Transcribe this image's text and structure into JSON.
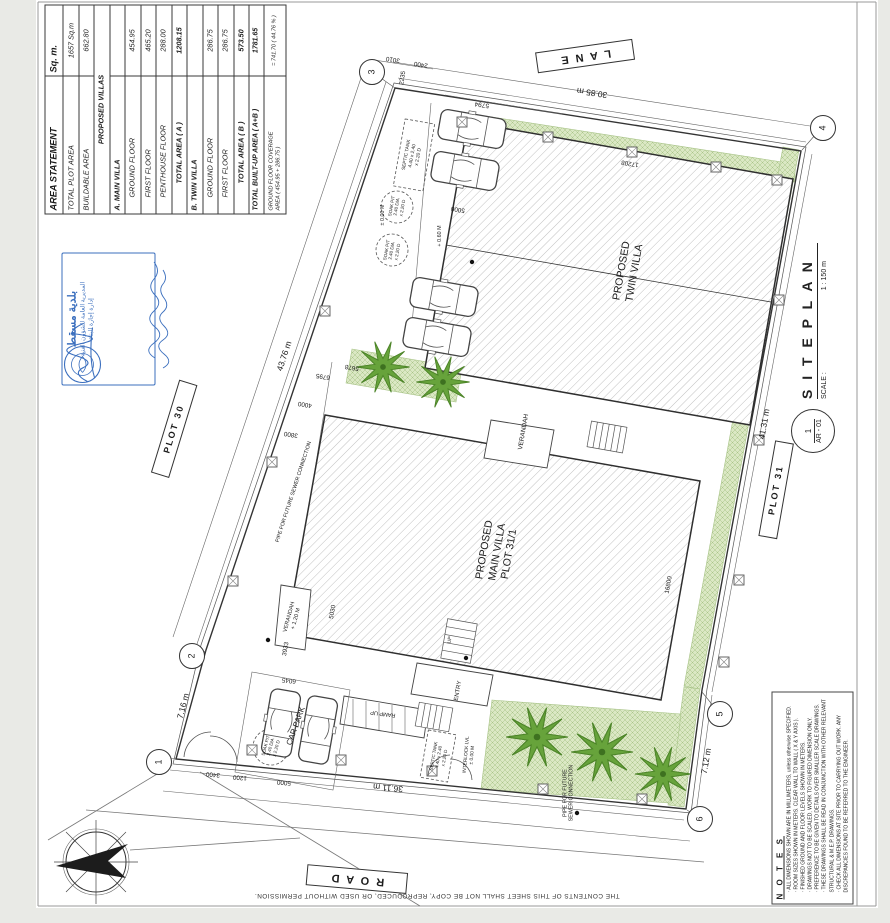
{
  "area_statement": {
    "title": "AREA STATEMENT",
    "unit": "Sq. m.",
    "rows": [
      {
        "label": "TOTAL PLOT AREA",
        "value": "1657 Sq.m",
        "cls": "plotrow"
      },
      {
        "label": "BUILDABLE AREA",
        "value": "662.80",
        "cls": ""
      },
      {
        "label": "PROPOSED VILLAS",
        "value": "",
        "cls": "section"
      },
      {
        "label": "A.   MAIN VILLA",
        "value": "",
        "cls": "villa"
      },
      {
        "label": "GROUND FLOOR",
        "value": "454.95",
        "cls": "indent"
      },
      {
        "label": "FIRST FLOOR",
        "value": "465.20",
        "cls": "indent"
      },
      {
        "label": "PENTHOUSE FLOOR",
        "value": "288.00",
        "cls": "indent"
      },
      {
        "label": "TOTAL AREA ( A )",
        "value": "1208.15",
        "cls": "total"
      },
      {
        "label": "B.   TWIN VILLA",
        "value": "",
        "cls": "villa"
      },
      {
        "label": "GROUND FLOOR",
        "value": "286.75",
        "cls": "indent"
      },
      {
        "label": "FIRST FLOOR",
        "value": "286.75",
        "cls": "indent"
      },
      {
        "label": "TOTAL AREA ( B )",
        "value": "573.50",
        "cls": "total"
      },
      {
        "label": "TOTAL BUILT-UP AREA  ( A+B )",
        "value": "1781.65",
        "cls": "grand"
      },
      {
        "label": "GROUND FLOOR COVERAGE\nAREA ( 454.95 + 286.75 )",
        "value": "=  741.70  ( 44.76 % )",
        "cls": "coverage"
      }
    ]
  },
  "stamp": {
    "title": "بلدية مسقط",
    "line2": "المديرية العامة للشؤون الفنية",
    "line3": "إدارة إجازة البناء"
  },
  "title_block": {
    "number": "1",
    "code": "AR - 01",
    "title": "S I T E   P L A N",
    "scale_label": "SCALE :",
    "scale": "1 : 150 m"
  },
  "notes": {
    "title": "N O T E S",
    "items": [
      "ALL DIMENSIONS SHOWN ARE IN MILLIMETERS, unless otherwise SPECIFIED.",
      "ROOM SIZES SHOWN IN METERS. CLEAR WALL TO WALL ( X & Y AXIS ).",
      "FINISHED GROUND AND FLOOR LEVELS SHOWN IN METERS.",
      "DRAWINGS NOT TO BE SCALED, WORK TO FIGURED DIMENSION ONLY.",
      "PREFERENCE TO BE GIVEN TO DETAILS OVER SMALLER SCALE DRAWINGS.",
      "THESE DRAWINGS SHALL BE READ IN CONJUNCTION WITH OTHER RELEVANT STRUCTURAL & M.E.P. DRAWINGS.",
      "CHECK ALL DIMENSIONS AT SITE PRIOR TO CARRYING OUT WORK. ANY DISCREPANCIES FOUND TO BE REFERRED TO THE ENGINEER."
    ]
  },
  "footer_note": "THE CONTENTS OF THIS SHEET SHALL NOT BE COPY, REPRODUCED, OR USED WITHOUT PERMISSION.",
  "plan": {
    "grid_bubbles": [
      {
        "n": "1",
        "x": 158,
        "y": 761
      },
      {
        "n": "2",
        "x": 191,
        "y": 655
      },
      {
        "n": "3",
        "x": 371,
        "y": 71
      },
      {
        "n": "4",
        "x": 822,
        "y": 127
      },
      {
        "n": "5",
        "x": 719,
        "y": 713
      },
      {
        "n": "6",
        "x": 699,
        "y": 818
      }
    ],
    "labels": [
      {
        "t": "L A N E",
        "x": 585,
        "y": 56,
        "r": 172,
        "s": 11,
        "boxed": 1,
        "name": "lane-label"
      },
      {
        "t": "R O A D",
        "x": 357,
        "y": 879,
        "r": 185,
        "s": 11,
        "boxed": 1,
        "name": "road-label"
      },
      {
        "t": "PLOT 30",
        "x": 174,
        "y": 429,
        "r": -73,
        "s": 9,
        "boxed": 1,
        "name": "plot-30-label"
      },
      {
        "t": "PLOT 31",
        "x": 776,
        "y": 490,
        "r": -80,
        "s": 9,
        "boxed": 1,
        "name": "plot-31-label"
      },
      {
        "t": "30.85 m",
        "x": 592,
        "y": 93,
        "r": 189,
        "s": 8.5,
        "name": "dimension-label"
      },
      {
        "t": "43.76 m",
        "x": 284,
        "y": 356,
        "r": -72,
        "s": 8.5,
        "name": "dimension-label"
      },
      {
        "t": "41.31 m",
        "x": 764,
        "y": 424,
        "r": -80,
        "s": 8.5,
        "name": "dimension-label"
      },
      {
        "t": "7.12 m",
        "x": 706,
        "y": 761,
        "r": -80,
        "s": 8.5,
        "name": "dimension-label"
      },
      {
        "t": "7.16 m",
        "x": 183,
        "y": 706,
        "r": -75,
        "s": 8.5,
        "name": "dimension-label"
      },
      {
        "t": "36.11 m",
        "x": 388,
        "y": 788,
        "r": 185,
        "s": 8.5,
        "name": "dimension-label"
      },
      {
        "t": "PIPE FOR FUTURE SEWER CONNECTION",
        "x": 294,
        "y": 492,
        "r": -72,
        "s": 5.3,
        "name": "pipe-note"
      },
      {
        "t": "PIPE FOR FUTURE\nSEWER CONNECTION",
        "x": 569,
        "y": 793,
        "r": -90,
        "s": 5.3,
        "name": "pipe-note"
      },
      {
        "t": "PROPOSED\nTWIN VILLA",
        "x": 628,
        "y": 272,
        "r": -80,
        "s": 10.5,
        "name": "twin-villa-label"
      },
      {
        "t": "PROPOSED\nMAIN VILLA\nPLOT 31/1",
        "x": 497,
        "y": 552,
        "r": -80,
        "s": 10.5,
        "name": "main-villa-label"
      },
      {
        "t": "VERANDAH",
        "x": 524,
        "y": 432,
        "r": -80,
        "s": 6.5
      },
      {
        "t": "VERANDAH\n+ 1.20 M",
        "x": 293,
        "y": 618,
        "r": -75,
        "s": 5.6
      },
      {
        "t": "CAR PARK",
        "x": 296,
        "y": 726,
        "r": -70,
        "s": 8,
        "name": "car-park-label"
      },
      {
        "t": "RAMP UP",
        "x": 383,
        "y": 713,
        "r": 187,
        "s": 5.6
      },
      {
        "t": "ENTRY",
        "x": 459,
        "y": 691,
        "r": -80,
        "s": 6,
        "name": "entry-label"
      },
      {
        "t": "UP",
        "x": 450,
        "y": 640,
        "r": -80,
        "s": 5
      },
      {
        "t": "SEPTIC TANK\n4.40 x 2.40\nx 2.20 D",
        "x": 413,
        "y": 156,
        "r": -80,
        "s": 4.8
      },
      {
        "t": "SOAK PIT\n2.40 DIA\nx 2.20 D",
        "x": 397,
        "y": 207,
        "r": -80,
        "s": 4.5
      },
      {
        "t": "SOAK PIT\n2.40 DIA\nx 2.20 D",
        "x": 392,
        "y": 251,
        "r": -80,
        "s": 4.5
      },
      {
        "t": "SOAK PIT\n2.40 DIA\nx 2.20 D",
        "x": 271,
        "y": 747,
        "r": -75,
        "s": 4.5
      },
      {
        "t": "SEPTIC TANK\n4.40 x 2.40\nx 2.20 D",
        "x": 439,
        "y": 757,
        "r": -80,
        "s": 4.5
      },
      {
        "t": "+ 0.60 M",
        "x": 440,
        "y": 236,
        "r": -90,
        "s": 5.4
      },
      {
        "t": "± 0.00 M",
        "x": 383,
        "y": 215,
        "r": -90,
        "s": 5.4
      },
      {
        "t": "INTERLOCK LVL\n± 0.00 M",
        "x": 470,
        "y": 755,
        "r": -85,
        "s": 4.8
      },
      {
        "t": "5794",
        "x": 482,
        "y": 104,
        "r": 189,
        "s": 6.5,
        "name": "dimension-label"
      },
      {
        "t": "3010",
        "x": 393,
        "y": 59,
        "r": 189,
        "s": 6.3,
        "name": "dimension-label"
      },
      {
        "t": "2400",
        "x": 421,
        "y": 64,
        "r": 189,
        "s": 6.3,
        "name": "dimension-label"
      },
      {
        "t": "2235",
        "x": 403,
        "y": 78,
        "r": -81,
        "s": 6.3,
        "name": "dimension-label"
      },
      {
        "t": "5000",
        "x": 458,
        "y": 209,
        "r": 189,
        "s": 6.3,
        "name": "dimension-label"
      },
      {
        "t": "5678",
        "x": 352,
        "y": 367,
        "r": 189,
        "s": 6.3,
        "name": "dimension-label"
      },
      {
        "t": "6795",
        "x": 323,
        "y": 376,
        "r": 189,
        "s": 6.3,
        "name": "dimension-label"
      },
      {
        "t": "4000",
        "x": 305,
        "y": 404,
        "r": 189,
        "s": 6.3,
        "name": "dimension-label"
      },
      {
        "t": "3800",
        "x": 291,
        "y": 434,
        "r": 189,
        "s": 6.3,
        "name": "dimension-label"
      },
      {
        "t": "3933",
        "x": 286,
        "y": 649,
        "r": -80,
        "s": 6.3,
        "name": "dimension-label"
      },
      {
        "t": "5030",
        "x": 333,
        "y": 612,
        "r": -80,
        "s": 6.3,
        "name": "dimension-label"
      },
      {
        "t": "6045",
        "x": 289,
        "y": 680,
        "r": 187,
        "s": 6.3,
        "name": "dimension-label"
      },
      {
        "t": "3400",
        "x": 213,
        "y": 774,
        "r": 185,
        "s": 6.3,
        "name": "dimension-label"
      },
      {
        "t": "1200",
        "x": 240,
        "y": 777,
        "r": 185,
        "s": 6.3,
        "name": "dimension-label"
      },
      {
        "t": "5000",
        "x": 284,
        "y": 782,
        "r": 185,
        "s": 6.3,
        "name": "dimension-label"
      },
      {
        "t": "17208",
        "x": 630,
        "y": 163,
        "r": 189,
        "s": 6.3,
        "name": "dimension-label"
      },
      {
        "t": "16800",
        "x": 669,
        "y": 585,
        "r": -80,
        "s": 6.3,
        "name": "dimension-label"
      }
    ],
    "colors": {
      "green_fill": "#dbe8c4",
      "green_line": "#a9c489",
      "tree_green": "#67a33b",
      "stamp_blue": "#3b6fbe",
      "line": "#444444"
    }
  }
}
